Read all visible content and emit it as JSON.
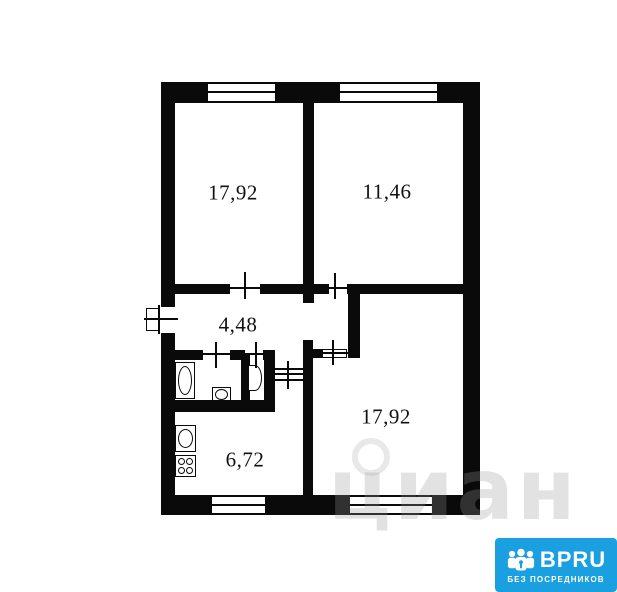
{
  "plan": {
    "type": "apartment-floor-plan",
    "rooms": [
      {
        "id": "room-top-left",
        "area_label": "17,92"
      },
      {
        "id": "room-top-right",
        "area_label": "11,46"
      },
      {
        "id": "hallway",
        "area_label": "4,48"
      },
      {
        "id": "kitchen",
        "area_label": "6,72"
      },
      {
        "id": "room-bottom-right",
        "area_label": "17,92"
      }
    ]
  },
  "watermark": {
    "text": "циан"
  },
  "logo": {
    "brand": "BPRU",
    "tagline": "БЕЗ ПОСРЕДНИКОВ",
    "bg_color": "#1A9FE0",
    "text_color": "#FFFFFF"
  },
  "colors": {
    "wall": "#0a0a0a",
    "background": "#ffffff",
    "watermark": "rgba(150,150,150,0.28)"
  }
}
